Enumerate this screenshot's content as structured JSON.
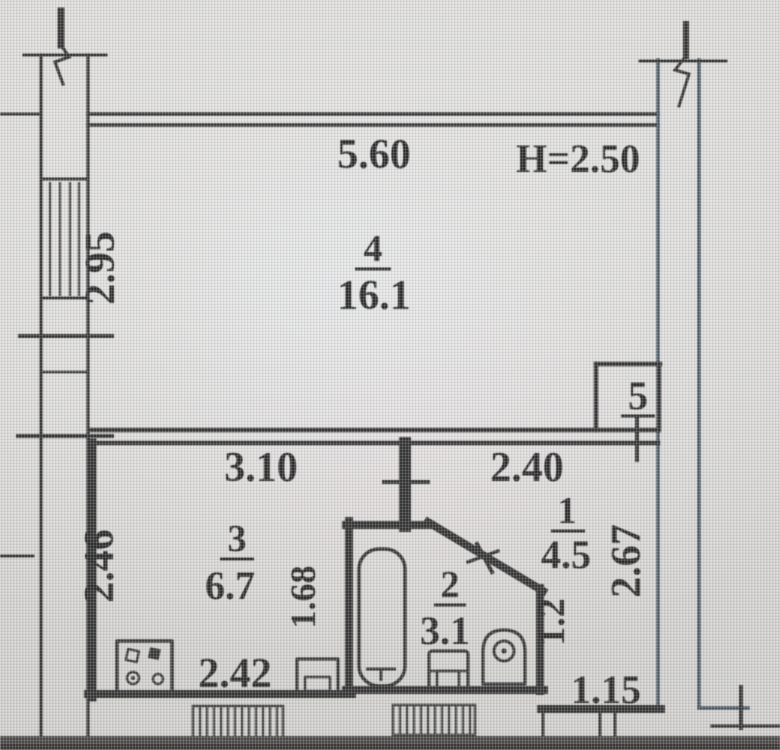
{
  "rooms": [
    {
      "number": "1",
      "area": "4.5"
    },
    {
      "number": "2",
      "area": "3.1"
    },
    {
      "number": "3",
      "area": "6.7"
    },
    {
      "number": "4",
      "area": "16.1"
    },
    {
      "number": "5",
      "area": ""
    }
  ],
  "dimensions": {
    "top_width": "5.60",
    "ceiling_height": "H=2.50",
    "left_depth": "2.95",
    "kitchen_width": "3.10",
    "hall_width": "2.40",
    "kitchen_left_depth": "2.46",
    "kitchen_lower_depth": "1.68",
    "kitchen_bottom_width": "2.42",
    "hall_right_depth": "2.67",
    "hall_lower_depth": "1.2",
    "hall_bottom_width": "1.15"
  },
  "fixtures": [
    "bathtub",
    "toilet",
    "washbasin",
    "gas-stove",
    "kitchen-sink"
  ],
  "colors": {
    "wall": "#2d2d2d",
    "text": "#232323",
    "paper": "#d6d5d3",
    "photo_edge": "#44423f"
  }
}
